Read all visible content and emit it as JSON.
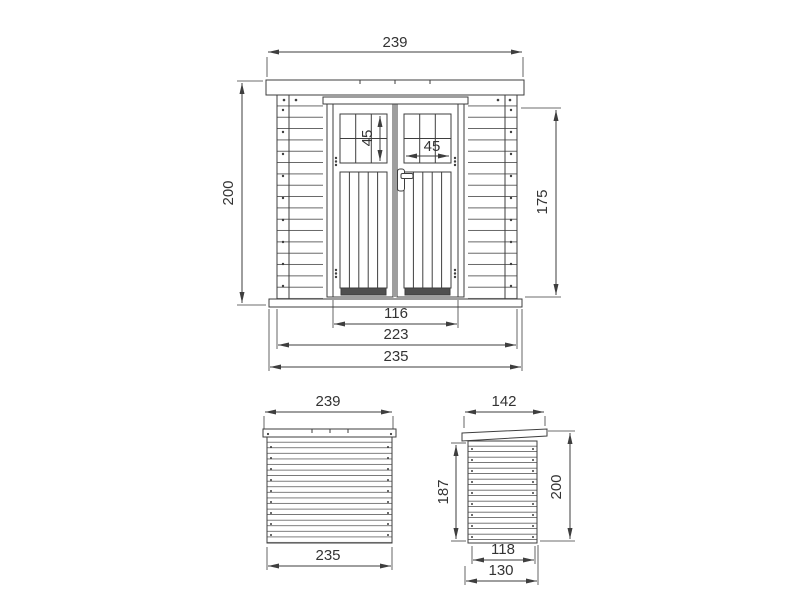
{
  "drawing_title": "shed-technical-drawing",
  "colors": {
    "line": "#3e3e3e",
    "text": "#333333",
    "background": "#ffffff",
    "door_base_strip": "#4f4f4f"
  },
  "front": {
    "roof_width": "239",
    "overall_height": "200",
    "window_height": "45",
    "window_width": "45",
    "side_wall_height": "175",
    "door_width": "116",
    "wall_width": "223",
    "base_width": "235"
  },
  "rear": {
    "roof_width": "239",
    "base_width": "235"
  },
  "side": {
    "roof_depth": "142",
    "rear_wall_height": "187",
    "overall_height": "200",
    "wall_depth": "118",
    "base_depth": "130"
  }
}
